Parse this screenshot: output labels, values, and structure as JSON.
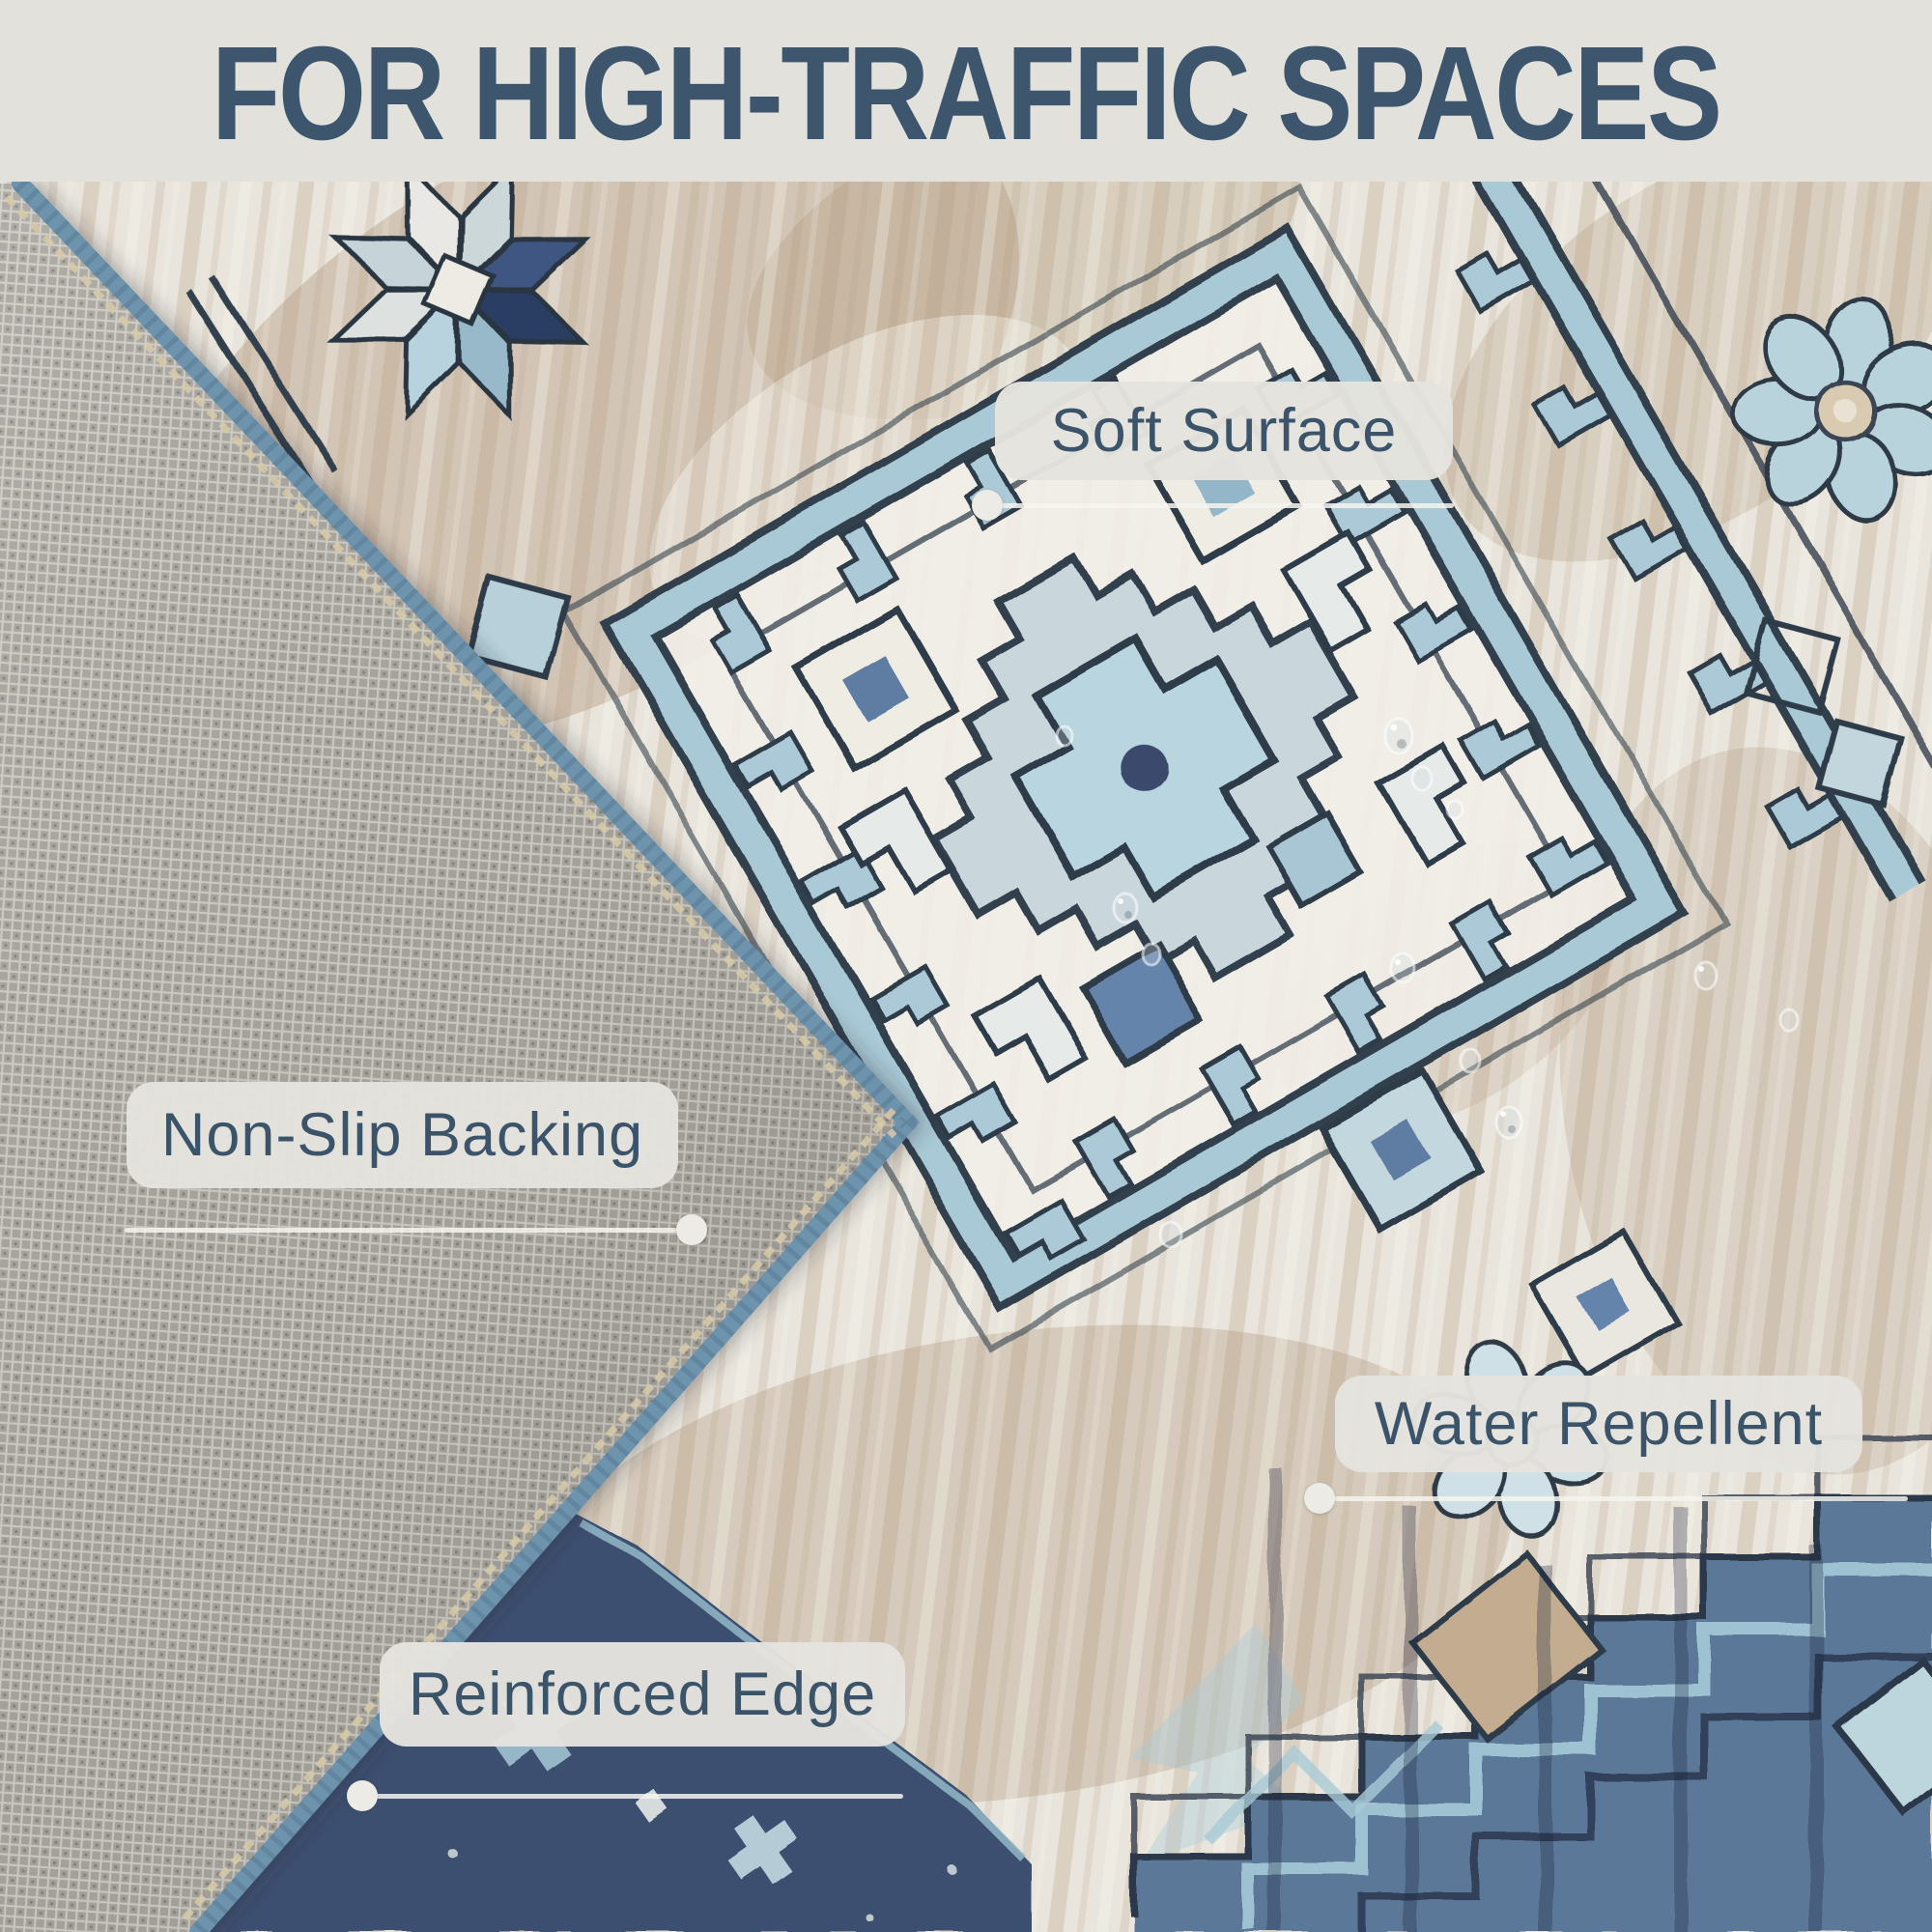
{
  "header": {
    "title": "FOR HIGH-TRAFFIC SPACES"
  },
  "callouts": [
    {
      "id": "soft-surface",
      "label": "Soft Surface"
    },
    {
      "id": "non-slip-backing",
      "label": "Non-Slip Backing"
    },
    {
      "id": "water-repellent",
      "label": "Water Repellent"
    },
    {
      "id": "reinforced-edge",
      "label": "Reinforced Edge"
    }
  ],
  "photo": {
    "alt": "Blue and cream southwestern medallion rug with its corner folded over showing a gray non-slip mesh backing and blue serged reinforced edge, with water droplets on the soft surface",
    "colors": {
      "header_bg": "#e3e1dc",
      "title_text": "#3e566d",
      "label_bg": "#e5e3de",
      "label_text": "#3b546a",
      "leader_line": "#f3f1ec",
      "rug_cream": "#e9e5dc",
      "rug_tan": "#b1977b",
      "rug_light_blue": "#a9c9d6",
      "rug_navy_outline": "#2e3a48",
      "rug_blue_border": "#5c7a9d",
      "rug_dark_navy": "#3d5070",
      "backing_gray": "#a6a29c",
      "edge_binding_blue": "#6e93ad",
      "edge_stitch_tan": "#d9cba9"
    }
  }
}
